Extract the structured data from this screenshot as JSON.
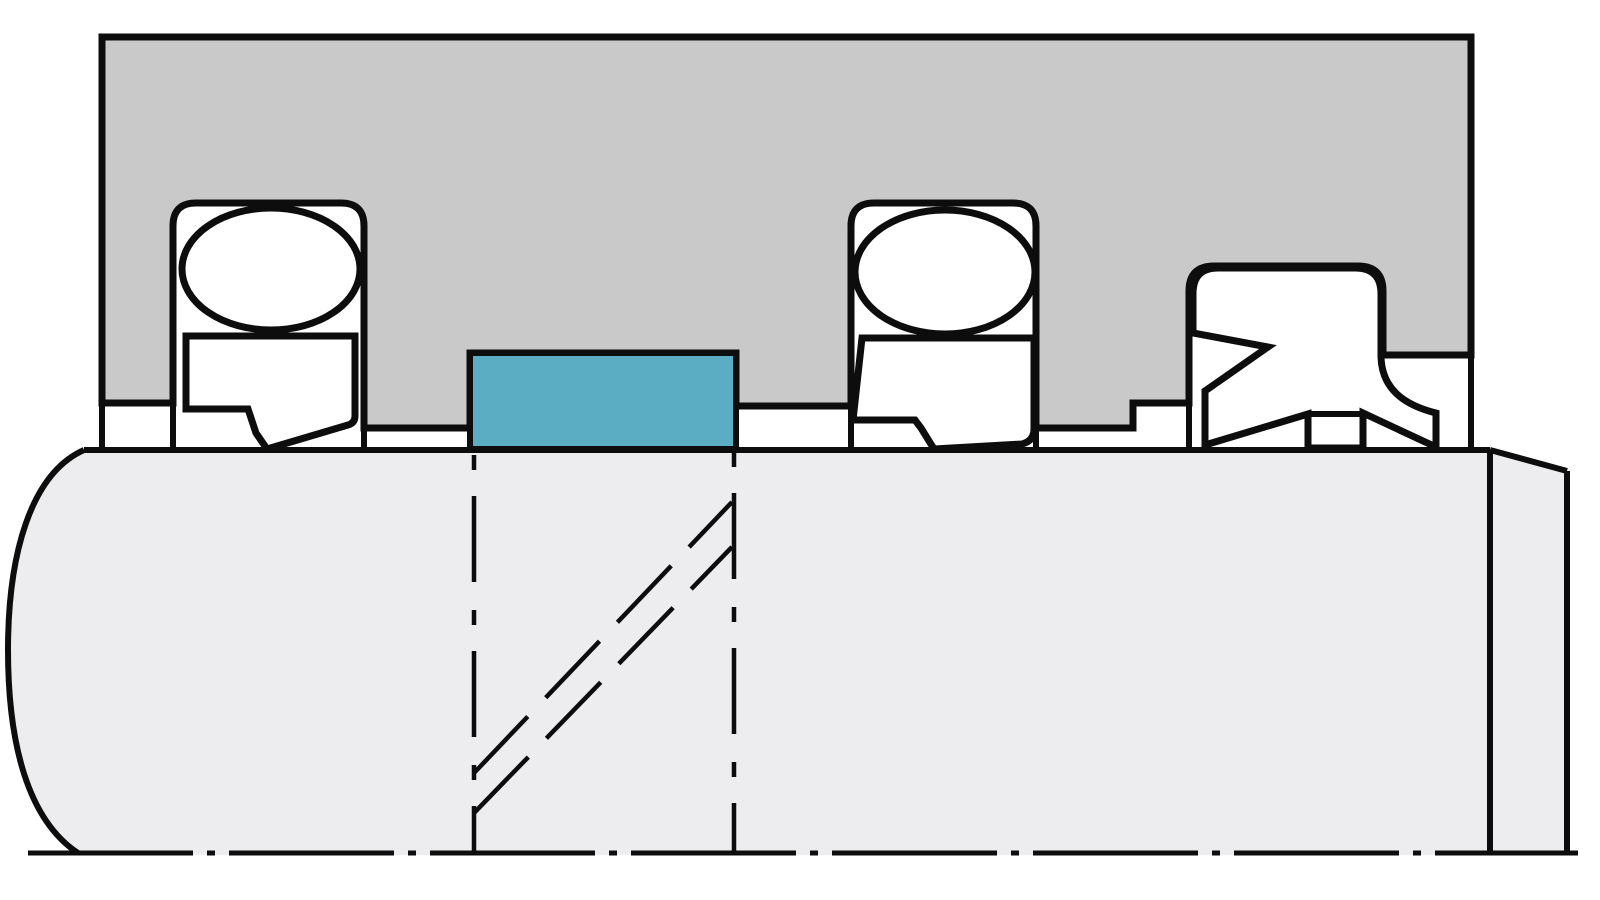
{
  "diagram": {
    "colors": {
      "background": "#ffffff",
      "line": "#0d0d0d",
      "housing_fill": "#c9c9c9",
      "rod_fill": "#ededef",
      "seal_fill": "#ffffff",
      "highlight_fill": "#5badc4"
    },
    "elements": {
      "housing": "housing-gland-block",
      "rod": "rod-shaft",
      "axis": "axis-centerline",
      "highlight_ring": "guide-ring-highlighted",
      "left_seal_oring": "o-ring-energizer-left",
      "left_seal_slipper": "slipper-seal-ring-left",
      "mid_seal_oring": "o-ring-energizer-middle",
      "mid_seal_slipper": "slipper-seal-ring-middle",
      "wiper": "wiper-seal",
      "section_lines": "section-projection-dashed-lines"
    }
  }
}
